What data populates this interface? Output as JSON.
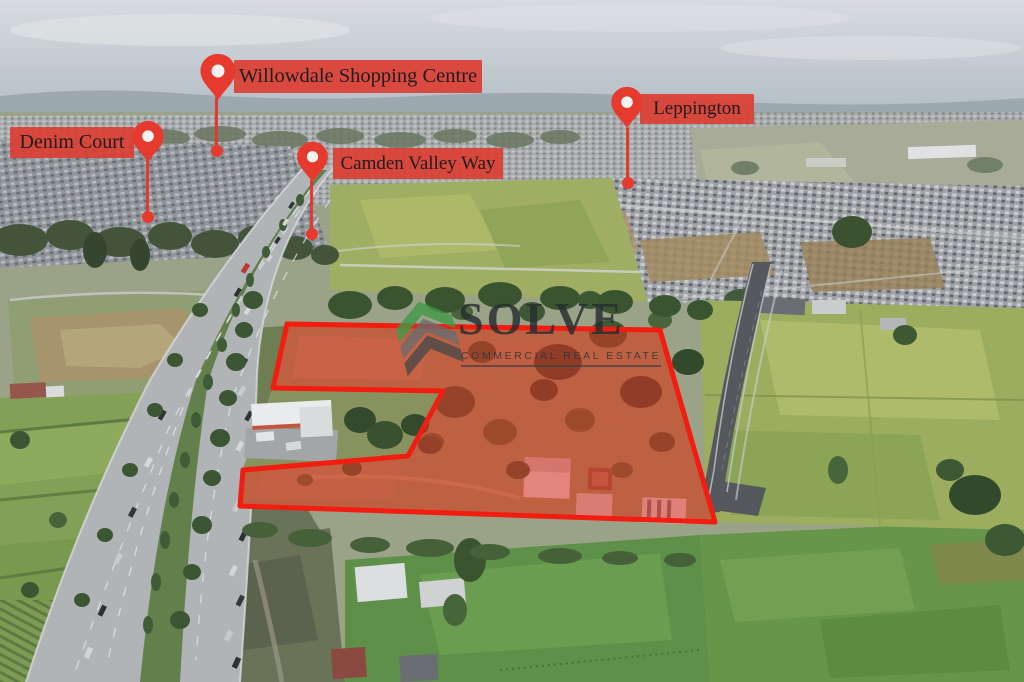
{
  "meta": {
    "description": "Aerial drone marketing photo of a development site beside Camden Valley Way with highlighted property boundary and nearby landmark pins"
  },
  "labels": {
    "willowdale": {
      "text": "Willowdale Shopping Centre"
    },
    "denim_court": {
      "text": "Denim Court"
    },
    "camden_valley_way": {
      "text": "Camden Valley Way"
    },
    "leppington": {
      "text": "Leppington"
    }
  },
  "watermark": {
    "brand": "SOLVE",
    "tagline": "COMMERCIAL REAL ESTATE"
  },
  "overlay": {
    "polygon_points": "287,324 660,330 715,522 240,506 243,470 408,456 443,391 273,388",
    "fill_color": "#f03020",
    "stroke_color": "#f21d10"
  },
  "colors": {
    "pin_red": "#e63a2e",
    "banner_red": "#db3f34",
    "banner_text": "#1d1d1d",
    "watermark_text": "#2e3438",
    "watermark_green": "#3f9a47",
    "sky": "#c3cad1",
    "paddock_green": "#83a156",
    "highway_gray": "#b0b4b7"
  }
}
